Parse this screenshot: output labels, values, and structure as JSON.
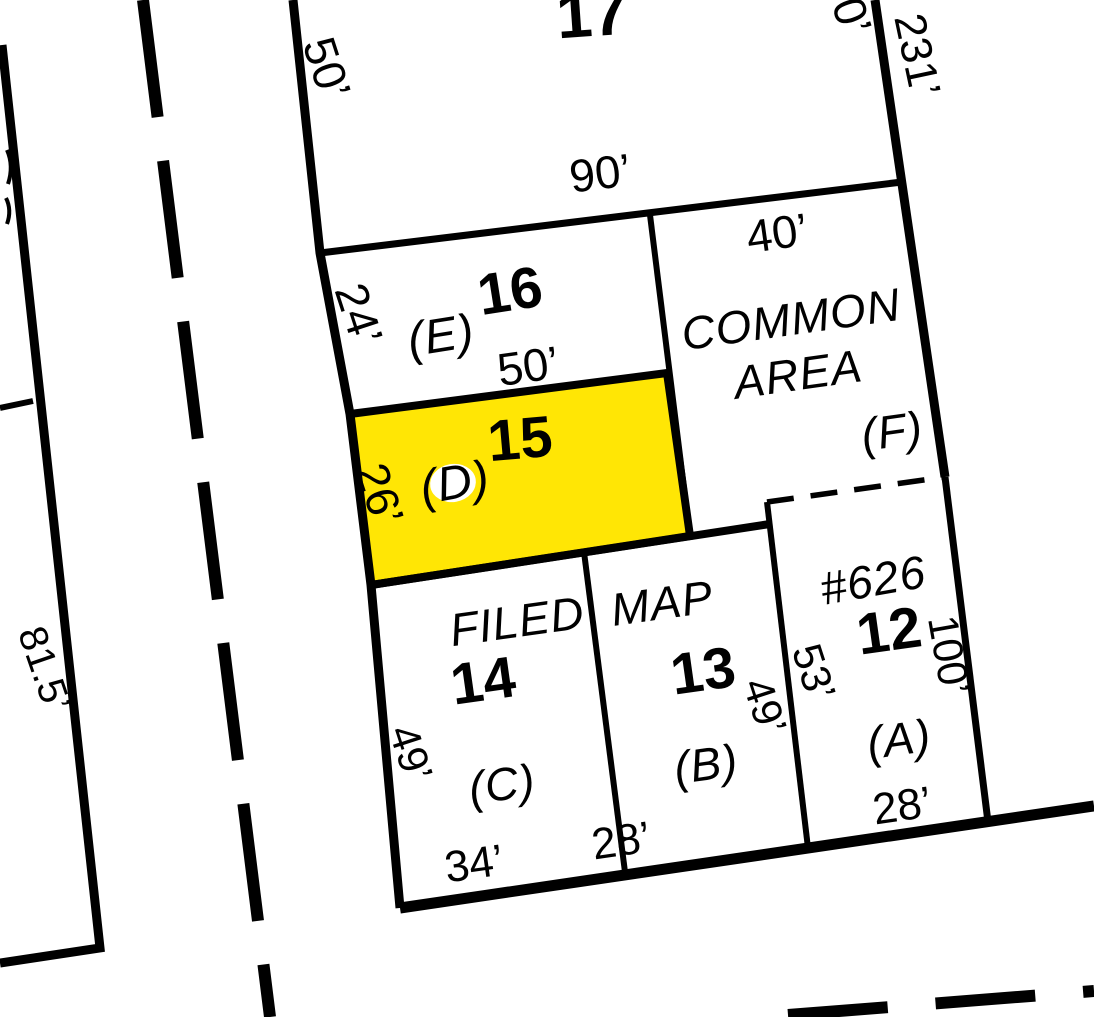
{
  "map": {
    "background_color": "#ffffff",
    "line_color": "#000000",
    "highlight_color": "#ffe605",
    "highlighted_parcel": "15",
    "parcels": {
      "lot17": {
        "number": "17",
        "west_dim": "50’",
        "south_dim": "90’",
        "east_dim": "231’",
        "east_dim_partial": "0’"
      },
      "lot16": {
        "number": "16",
        "letter": "(E)",
        "west_dim": "24’",
        "south_dim": "50’"
      },
      "lot15": {
        "number": "15",
        "letter": "(D)",
        "west_dim": "26’",
        "highlighted": true
      },
      "common_area": {
        "name_line1": "COMMON",
        "name_line2": "AREA",
        "letter": "(F)",
        "north_dim": "40’"
      },
      "lot14": {
        "number": "14",
        "letter": "(C)",
        "west_dim": "49’",
        "south_dim": "34’",
        "overlay_text": "FILED"
      },
      "lot13": {
        "number": "13",
        "letter": "(B)",
        "east_dim": "49’",
        "south_dim": "28’",
        "overlay_text": "MAP"
      },
      "lot12": {
        "number": "12",
        "letter": "(A)",
        "map_ref": "#626",
        "west_dim": "53’",
        "east_dim": "100’",
        "south_dim": "28’"
      },
      "adjacent_west": {
        "dim": "81.5’"
      }
    }
  }
}
